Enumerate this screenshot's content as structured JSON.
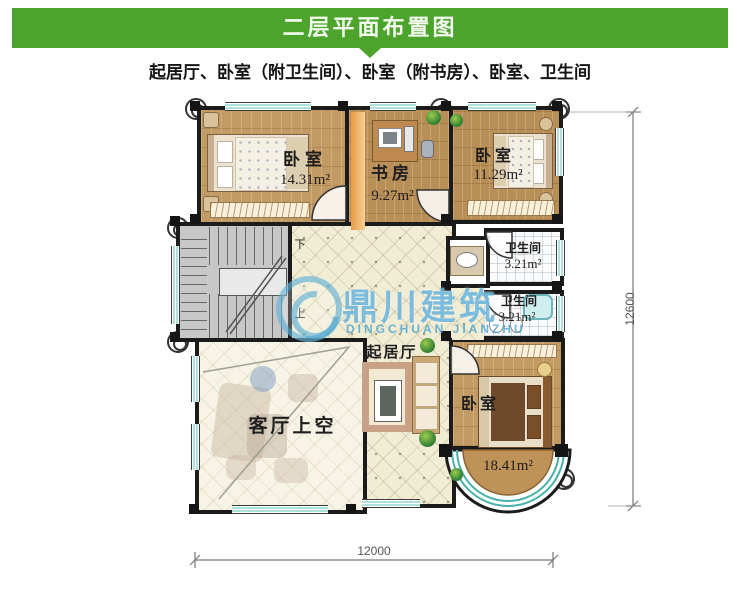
{
  "header": {
    "title": "二层平面布置图"
  },
  "subtitle": "起居厅、卧室（附卫生间）、卧室（附书房）、卧室、卫生间",
  "watermark": {
    "cn": "鼎川建筑",
    "en": "DINGCHUAN JIANZHU"
  },
  "rooms": {
    "bedroom_tl": {
      "name": "卧室",
      "area": "14.31m²"
    },
    "study": {
      "name": "书房",
      "area": "9.27m²"
    },
    "bedroom_tr": {
      "name": "卧室",
      "area": "11.29m²"
    },
    "bath_upper": {
      "name": "卫生间",
      "area": "3.21m²"
    },
    "bath_lower": {
      "name": "卫生间",
      "area": "3.21m²"
    },
    "living_hall": {
      "name": "起居厅"
    },
    "void": {
      "name": "客厅上空"
    },
    "bedroom_br": {
      "name": "卧室",
      "area": "18.41m²"
    }
  },
  "stairs": {
    "down": "下",
    "up": "上"
  },
  "dimensions": {
    "bottom": "12000",
    "right": "12600"
  },
  "colors": {
    "header_green": "#4CA42D",
    "watermark_blue": "#46A5D2",
    "wood": "#C29A63",
    "window_teal": "#5FC0BA"
  }
}
